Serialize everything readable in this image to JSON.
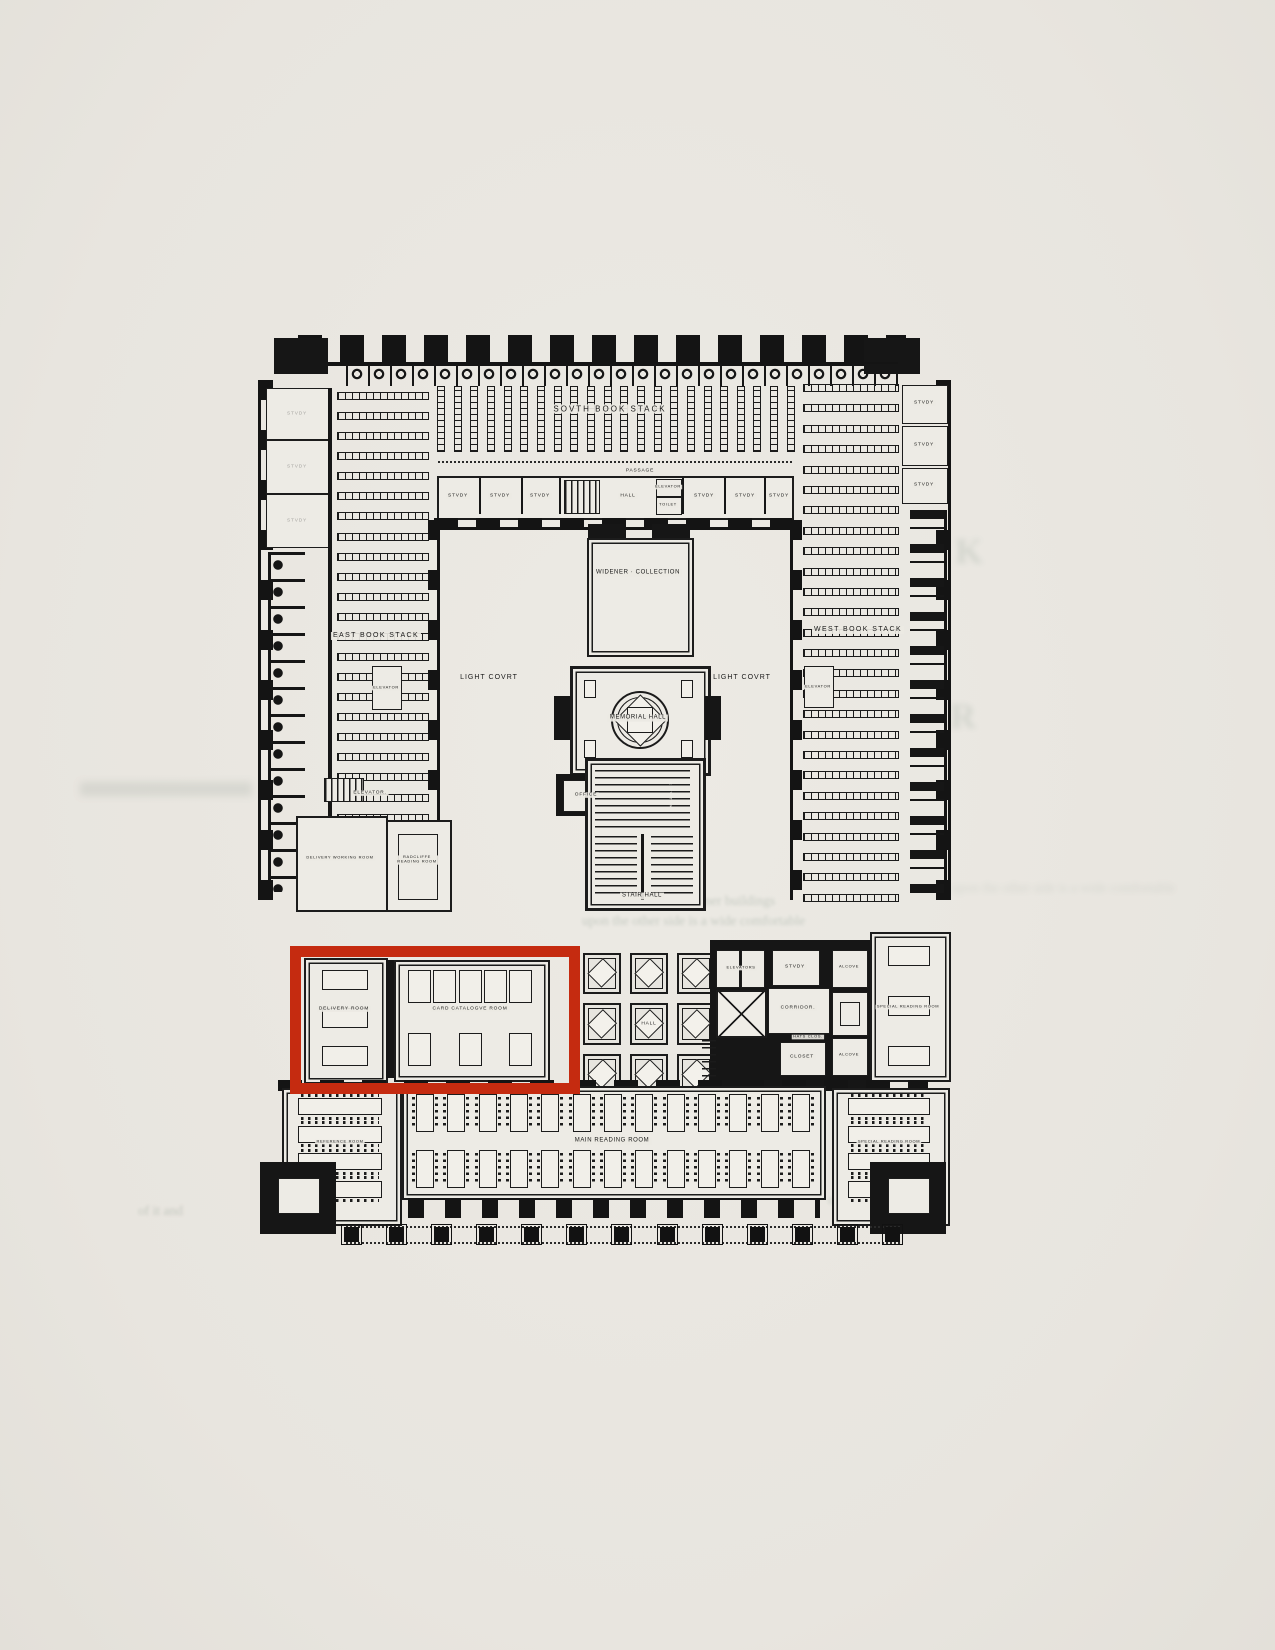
{
  "labels": {
    "south_book_stack": "SOVTH BOOK STACK",
    "passage": "PASSAGE",
    "study": "STVDY",
    "hall": "HALL",
    "toilet": "TOILET",
    "elevator": "ELEVATOR",
    "elevator_dot": "ELEVATOR.",
    "elevators": "ELEVATORS",
    "east_book_stack": "EAST BOOK STACK",
    "west_book_stack": "WEST BOOK STACK",
    "light_court": "LIGHT COVRT",
    "widener_collection": "WIDENER · COLLECTION",
    "memorial_hall": "MEMORIAL HALL",
    "office": "OFFICE",
    "stair_hall": "STAIR HALL",
    "delivery_working_room": "DELIVERY WORKING ROOM",
    "radcliffe_line1": "RADCLIFFE",
    "radcliffe_line2": "READING ROOM",
    "delivery_room": "DELIVERY ROOM",
    "card_catalogue_room": "CARD CATALOGVE ROOM",
    "corridor": "CORRIDOR.",
    "alcove": "ALCOVE",
    "hats_closet": "HATS CLOS.",
    "closet": "CLOSET",
    "special_reading_room": "SPECIAL READING ROOM",
    "reference_room": "REFERENCE ROOM",
    "main_reading_room": "MAIN READING ROOM"
  },
  "highlight": {
    "color": "#c52b10"
  },
  "bleedthrough": {
    "line1": "a catend the Widener buildings",
    "line2": "upon the other side is a wide comfortable",
    "line3": "or escalators. It",
    "line4": "of it and",
    "letter1": "K",
    "letter2": "R"
  }
}
